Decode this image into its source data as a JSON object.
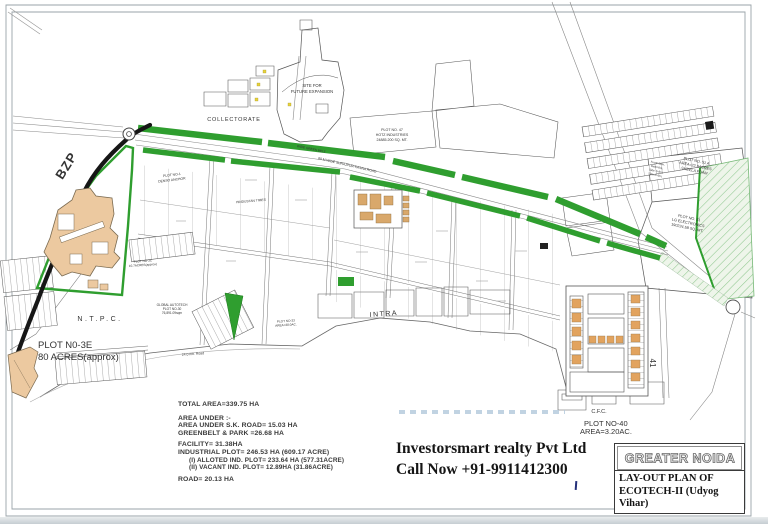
{
  "map": {
    "region_labels": {
      "bzp": "BZP",
      "collectorate": "COLLECTORATE",
      "site_future_line1": "SITE FOR",
      "site_future_line2": "FUTURE EXPANSION",
      "ntpc": "N.T.P.C.",
      "intra": "INTRA",
      "road_41": "41",
      "cfc": "C.F.C."
    },
    "road_labels": {
      "surajpur_kasna": "80 M WIDE SURAJPUR-KASNA ROAD",
      "green_belt": "WIDE GREEN BELT",
      "road_24": "24.0 mtr. Road"
    },
    "plot_labels": {
      "plot47_line1": "PLOT NO. 47",
      "plot47_line2": "HOTZ INDUSTRIES",
      "plot47_line3": "24885.200 SQ. MT.",
      "plot3e_line1": "PLOT N0-3E",
      "plot3e_line2": "80 ACRES(approx)",
      "global_autotech_line1": "GLOBAL AUTOTECH",
      "global_autotech_line2": "PLOT NO-30",
      "global_autotech_line3": "76,891.09sqm",
      "plot3c_line1": "PLOT NO-3C",
      "plot3c_line2": "10.7ACRES(approx)",
      "plot1_line1": "PLOT NO-1",
      "plot1_line2": "DENSO ANCHOR",
      "plot2_line1": "HINDUSTAN TIMES",
      "plot33_line1": "PLOT NO-33",
      "plot33_line2": "AREA=38.0AC.",
      "plot51a_line1": "PLOT NO. 51 A",
      "plot51a_line2": "AREA=22.9ACRES",
      "plot51a_line3": "SHEELA FOAM",
      "plot51a_setback1": "Front=20m,",
      "plot51a_setback2": "Rear=8m,",
      "plot51a_setback3": "Side-1=8m,",
      "plot51a_setback4": "Side-2=8m,",
      "plot51_line1": "PLOT NO. 51",
      "plot51_line2": "LG ELECTRONICS",
      "plot51_line3": "190224.58 SQ. MT.",
      "plot40_line1": "PLOT NO-40",
      "plot40_line2": "AREA=3.20AC."
    }
  },
  "stats": {
    "lines": [
      "TOTAL AREA=339.75 HA",
      "AREA UNDER :-",
      "AREA UNDER S.K. ROAD= 15.03 HA",
      "GREENBELT & PARK =26.68 HA",
      "FACILITY= 31.38HA",
      "INDUSTRIAL PLOT= 246.53 HA (609.17 ACRE)",
      "(I) ALLOTED IND. PLOT= 233.64 HA (577.31ACRE)",
      "(II) VACANT IND. PLOT= 12.89HA (31.86ACRE)",
      "ROAD= 20.13 HA"
    ]
  },
  "contact": {
    "company": "Investorsmart realty Pvt Ltd",
    "phone_line": "Call Now +91-9911412300"
  },
  "title_block": {
    "region_name": "GREATER NOIDA",
    "plan_title": "LAY-OUT PLAN OF ECOTECH-II (Udyog Vihar)"
  },
  "colors": {
    "road_green": "#2f9e2f",
    "plot_tan": "#ecc9a0",
    "accent_orange": "#e2a35e",
    "watermark_blue": "#b6cbdd"
  }
}
